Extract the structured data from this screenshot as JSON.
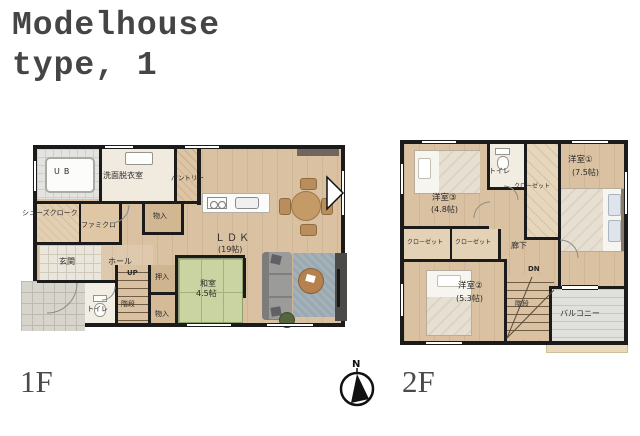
{
  "title": {
    "line1": "Modelhouse",
    "line2": "type, 1"
  },
  "compass": {
    "north": "N"
  },
  "floor1": {
    "label": "1F",
    "rooms": {
      "ub": "UB",
      "washroom": "洗面脱衣室",
      "pantry": "パントリー",
      "shoes_cloak": "シューズクローク",
      "family_closet": "ファミクロ",
      "genkan": "玄関",
      "hall": "ホール",
      "up": "UP",
      "storage_top": "物入",
      "oshiire": "押入",
      "toilet": "トイレ",
      "stairs": "階段",
      "storage_bottom": "物入",
      "washitsu": "和室",
      "washitsu_size": "4.5帖",
      "ldk": "ＬＤＫ",
      "ldk_size": "(19帖)"
    }
  },
  "floor2": {
    "label": "2F",
    "rooms": {
      "bedroom3": "洋室③",
      "bedroom3_size": "(4.8帖)",
      "toilet": "トイレ",
      "closet": "クローゼット",
      "bedroom1": "洋室①",
      "bedroom1_size": "(7.5帖)",
      "closet_a": "クローゼット",
      "closet_b": "クローゼット",
      "hallway": "廊下",
      "dn": "DN",
      "bedroom2": "洋室②",
      "bedroom2_size": "(5.3帖)",
      "stairs": "階段",
      "balcony": "バルコニー"
    }
  },
  "palette": {
    "wall": "#1b1b1b",
    "wood": "#d9c1a1",
    "tatami": "#c9d4a2",
    "rug": "#9aa8b0",
    "tile": "#ebe6db"
  }
}
